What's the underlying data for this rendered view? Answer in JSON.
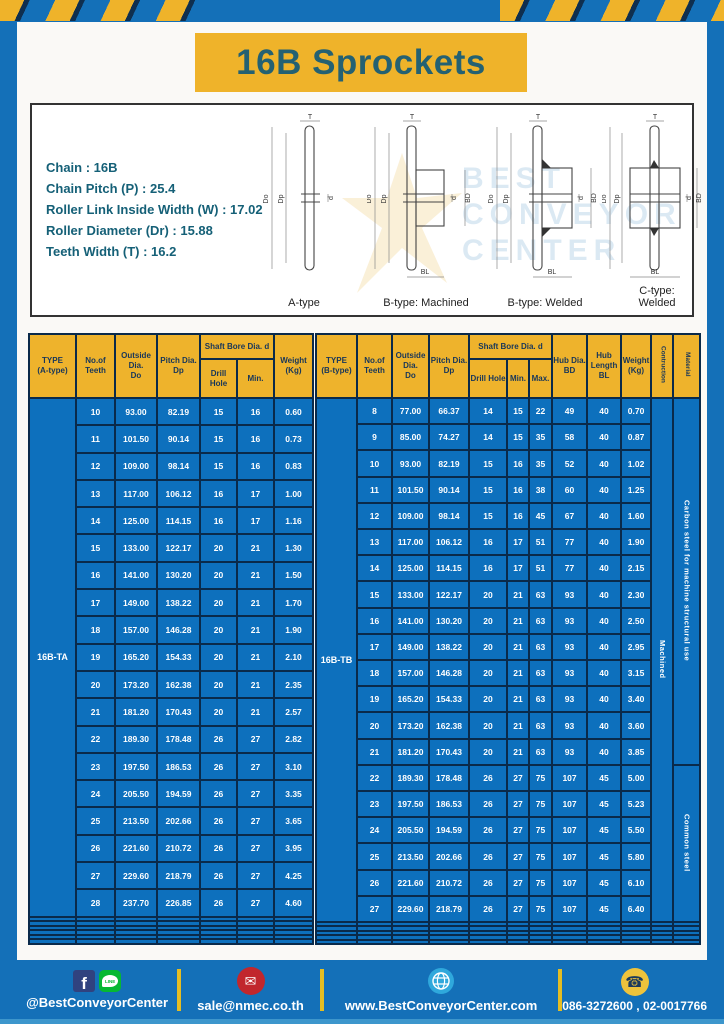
{
  "title": "16B Sprockets",
  "specs": {
    "lines": [
      "Chain : 16B",
      "Chain Pitch (P) : 25.4",
      "Roller Link Inside Width (W) : 17.02",
      "Roller Diameter (Dr) : 15.88",
      "Teeth Width (T) : 16.2"
    ]
  },
  "diagrams": {
    "labels": [
      "A-type",
      "B-type: Machined",
      "B-type: Welded",
      "C-type: Welded"
    ],
    "dims": {
      "t": "T",
      "doo": "Do",
      "dp": "Dp",
      "d": "d",
      "bd": "BD",
      "bl": "BL"
    },
    "watermark": {
      "line1": "BEST",
      "line2": "CONVEYOR",
      "line3": "CENTER"
    }
  },
  "table_a": {
    "type_label": "16B-TA",
    "headers": {
      "type": "TYPE\n(A-type)",
      "teeth": "No.of\nTeeth",
      "outside": "Outside\nDia.\nDo",
      "pitch": "Pitch Dia.\nDp",
      "shaft_bore": "Shaft Bore Dia. d",
      "drill": "Drill Hole",
      "min": "Min.",
      "weight": "Weight\n(Kg)"
    },
    "rows": [
      [
        "10",
        "93.00",
        "82.19",
        "15",
        "16",
        "0.60"
      ],
      [
        "11",
        "101.50",
        "90.14",
        "15",
        "16",
        "0.73"
      ],
      [
        "12",
        "109.00",
        "98.14",
        "15",
        "16",
        "0.83"
      ],
      [
        "13",
        "117.00",
        "106.12",
        "16",
        "17",
        "1.00"
      ],
      [
        "14",
        "125.00",
        "114.15",
        "16",
        "17",
        "1.16"
      ],
      [
        "15",
        "133.00",
        "122.17",
        "20",
        "21",
        "1.30"
      ],
      [
        "16",
        "141.00",
        "130.20",
        "20",
        "21",
        "1.50"
      ],
      [
        "17",
        "149.00",
        "138.22",
        "20",
        "21",
        "1.70"
      ],
      [
        "18",
        "157.00",
        "146.28",
        "20",
        "21",
        "1.90"
      ],
      [
        "19",
        "165.20",
        "154.33",
        "20",
        "21",
        "2.10"
      ],
      [
        "20",
        "173.20",
        "162.38",
        "20",
        "21",
        "2.35"
      ],
      [
        "21",
        "181.20",
        "170.43",
        "20",
        "21",
        "2.57"
      ],
      [
        "22",
        "189.30",
        "178.48",
        "26",
        "27",
        "2.82"
      ],
      [
        "23",
        "197.50",
        "186.53",
        "26",
        "27",
        "3.10"
      ],
      [
        "24",
        "205.50",
        "194.59",
        "26",
        "27",
        "3.35"
      ],
      [
        "25",
        "213.50",
        "202.66",
        "26",
        "27",
        "3.65"
      ],
      [
        "26",
        "221.60",
        "210.72",
        "26",
        "27",
        "3.95"
      ],
      [
        "27",
        "229.60",
        "218.79",
        "26",
        "27",
        "4.25"
      ],
      [
        "28",
        "237.70",
        "226.85",
        "26",
        "27",
        "4.60"
      ]
    ],
    "empty_rows": 6
  },
  "table_b": {
    "type_label": "16B-TB",
    "headers": {
      "type": "TYPE\n(B-type)",
      "teeth": "No.of\nTeeth",
      "outside": "Outside\nDia.\nDo",
      "pitch": "Pitch Dia.\nDp",
      "shaft_bore": "Shaft Bore Dia. d",
      "drill": "Drill Hole",
      "min": "Min.",
      "max": "Max.",
      "hub_dia": "Hub Dia.\nBD",
      "hub_len": "Hub\nLength\nBL",
      "weight": "Weight\n(Kg)",
      "construction": "Contruction",
      "material": "Material"
    },
    "rows": [
      [
        "8",
        "77.00",
        "66.37",
        "14",
        "15",
        "22",
        "49",
        "40",
        "0.70"
      ],
      [
        "9",
        "85.00",
        "74.27",
        "14",
        "15",
        "35",
        "58",
        "40",
        "0.87"
      ],
      [
        "10",
        "93.00",
        "82.19",
        "15",
        "16",
        "35",
        "52",
        "40",
        "1.02"
      ],
      [
        "11",
        "101.50",
        "90.14",
        "15",
        "16",
        "38",
        "60",
        "40",
        "1.25"
      ],
      [
        "12",
        "109.00",
        "98.14",
        "15",
        "16",
        "45",
        "67",
        "40",
        "1.60"
      ],
      [
        "13",
        "117.00",
        "106.12",
        "16",
        "17",
        "51",
        "77",
        "40",
        "1.90"
      ],
      [
        "14",
        "125.00",
        "114.15",
        "16",
        "17",
        "51",
        "77",
        "40",
        "2.15"
      ],
      [
        "15",
        "133.00",
        "122.17",
        "20",
        "21",
        "63",
        "93",
        "40",
        "2.30"
      ],
      [
        "16",
        "141.00",
        "130.20",
        "20",
        "21",
        "63",
        "93",
        "40",
        "2.50"
      ],
      [
        "17",
        "149.00",
        "138.22",
        "20",
        "21",
        "63",
        "93",
        "40",
        "2.95"
      ],
      [
        "18",
        "157.00",
        "146.28",
        "20",
        "21",
        "63",
        "93",
        "40",
        "3.15"
      ],
      [
        "19",
        "165.20",
        "154.33",
        "20",
        "21",
        "63",
        "93",
        "40",
        "3.40"
      ],
      [
        "20",
        "173.20",
        "162.38",
        "20",
        "21",
        "63",
        "93",
        "40",
        "3.60"
      ],
      [
        "21",
        "181.20",
        "170.43",
        "20",
        "21",
        "63",
        "93",
        "40",
        "3.85"
      ],
      [
        "22",
        "189.30",
        "178.48",
        "26",
        "27",
        "75",
        "107",
        "45",
        "5.00"
      ],
      [
        "23",
        "197.50",
        "186.53",
        "26",
        "27",
        "75",
        "107",
        "45",
        "5.23"
      ],
      [
        "24",
        "205.50",
        "194.59",
        "26",
        "27",
        "75",
        "107",
        "45",
        "5.50"
      ],
      [
        "25",
        "213.50",
        "202.66",
        "26",
        "27",
        "75",
        "107",
        "45",
        "5.80"
      ],
      [
        "26",
        "221.60",
        "210.72",
        "26",
        "27",
        "75",
        "107",
        "45",
        "6.10"
      ],
      [
        "27",
        "229.60",
        "218.79",
        "26",
        "27",
        "75",
        "107",
        "45",
        "6.40"
      ]
    ],
    "construction_value": "Machined",
    "materials": [
      {
        "label": "Carbon steel for machine structural use",
        "span": 14
      },
      {
        "label": "Common steel",
        "span": 6
      }
    ],
    "empty_rows": 5
  },
  "footer": {
    "social_handle": "@BestConveyorCenter",
    "email": "sale@nmec.co.th",
    "website": "www.BestConveyorCenter.com",
    "phones": "086-3272600 , 02-0017766",
    "icons": {
      "facebook": "f",
      "line": "LINE",
      "email": "✉",
      "phone": "☎"
    }
  }
}
